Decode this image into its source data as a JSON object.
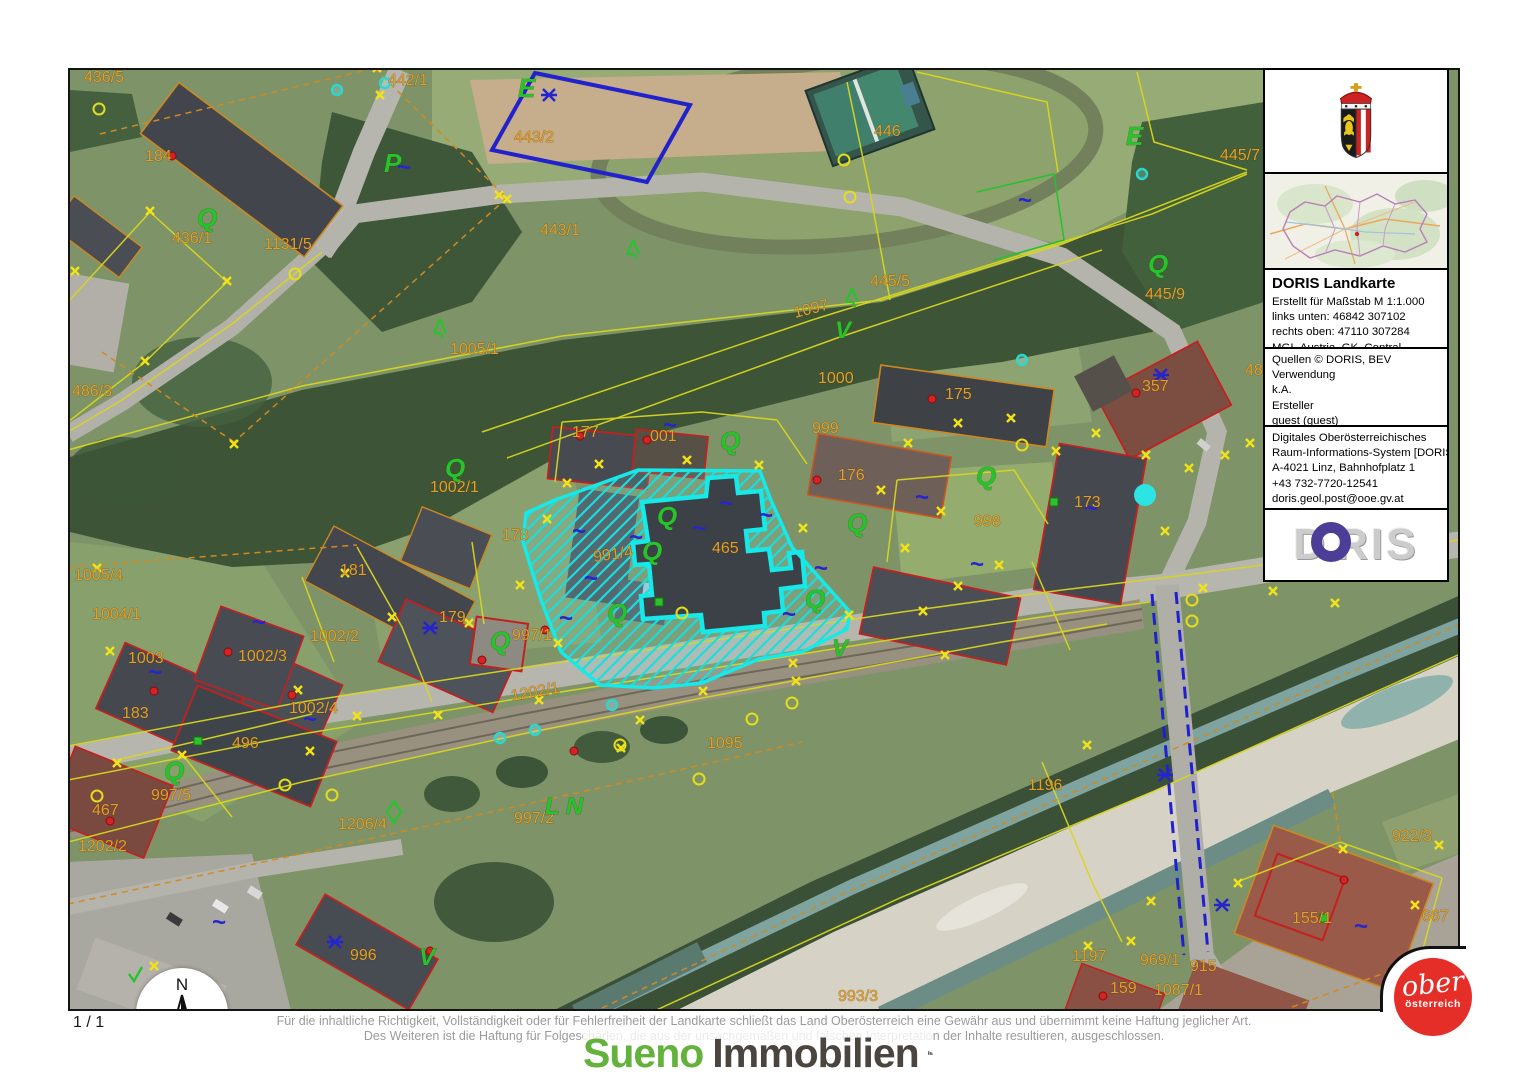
{
  "page": {
    "page_number": "1 / 1"
  },
  "scalebar": {
    "start": "0",
    "mid": "40",
    "unit": "m"
  },
  "north_label": "N",
  "disclaimer": {
    "line1": "Für die inhaltliche Richtigkeit, Vollständigkeit oder für Fehlerfreiheit der Landkarte schließt das Land Oberösterreich eine Gewähr aus und übernimmt keine Haftung jeglicher Art.",
    "line2": "Des Weiteren ist die Haftung für Folgeschäden, die aus der unsachgemäßen und falschen Interpretation der Inhalte resultieren, ausgeschlossen."
  },
  "branding": {
    "sueno_part1": "Sueno",
    "sueno_part2": "Immobilien",
    "ooe_line1": "ober",
    "ooe_line2": "österreich"
  },
  "sidebar": {
    "title": "DORIS Landkarte",
    "map_info": [
      "Erstellt für Maßstab M 1:1.000",
      "links unten: 46842 307102",
      "rechts oben: 47110 307284",
      "MGI_Austria_GK_Central"
    ],
    "source_info": [
      "Quellen © DORIS, BEV",
      "Verwendung",
      "k.A.",
      "Ersteller",
      "guest (guest)",
      "Erstellungsdatum: 28.01.2026"
    ],
    "contact_info": [
      "Digitales Oberösterreichisches",
      "Raum-Informations-System [DORIS]",
      "A-4021 Linz, Bahnhofplatz 1",
      "+43 732-7720-12541",
      "doris.geol.post@ooe.gv.at",
      "https://doris.ooe.gv.at"
    ],
    "logo": {
      "d": "D",
      "ris": "RIS"
    }
  },
  "map": {
    "highlight_color": "#17e8e8",
    "parcel_line_color": "#d8d61f",
    "label_color": "#e2a02a",
    "labels": [
      {
        "t": "436/5",
        "x": 82,
        "y": 80
      },
      {
        "t": "442/1",
        "x": 386,
        "y": 83
      },
      {
        "t": "443/2",
        "x": 512,
        "y": 140
      },
      {
        "t": "446",
        "x": 872,
        "y": 134
      },
      {
        "t": "445/7",
        "x": 1218,
        "y": 158
      },
      {
        "t": "436/1",
        "x": 170,
        "y": 241
      },
      {
        "t": "1131/5",
        "x": 262,
        "y": 247
      },
      {
        "t": "443/1",
        "x": 538,
        "y": 233
      },
      {
        "t": "445/5",
        "x": 868,
        "y": 284
      },
      {
        "t": "445/9",
        "x": 1143,
        "y": 297
      },
      {
        "t": "486/3",
        "x": 70,
        "y": 394
      },
      {
        "t": "1005/1",
        "x": 448,
        "y": 352
      },
      {
        "t": "1097",
        "x": 793,
        "y": 316,
        "r": -14
      },
      {
        "t": "1000",
        "x": 816,
        "y": 381
      },
      {
        "t": "175",
        "x": 943,
        "y": 397
      },
      {
        "t": "357",
        "x": 1140,
        "y": 389
      },
      {
        "t": "48",
        "x": 1243,
        "y": 373
      },
      {
        "t": "177",
        "x": 570,
        "y": 435
      },
      {
        "t": "001",
        "x": 648,
        "y": 439
      },
      {
        "t": "999",
        "x": 810,
        "y": 431
      },
      {
        "t": "176",
        "x": 836,
        "y": 478
      },
      {
        "t": "1002/1",
        "x": 428,
        "y": 490
      },
      {
        "t": "178",
        "x": 500,
        "y": 538
      },
      {
        "t": "465",
        "x": 710,
        "y": 551
      },
      {
        "t": "991/4",
        "x": 592,
        "y": 560,
        "r": -8
      },
      {
        "t": "173",
        "x": 1072,
        "y": 505
      },
      {
        "t": "998",
        "x": 972,
        "y": 524
      },
      {
        "t": "181",
        "x": 338,
        "y": 573
      },
      {
        "t": "1005/4",
        "x": 72,
        "y": 578
      },
      {
        "t": "1004/1",
        "x": 90,
        "y": 617
      },
      {
        "t": "179",
        "x": 437,
        "y": 620
      },
      {
        "t": "997/1",
        "x": 510,
        "y": 638
      },
      {
        "t": "1003",
        "x": 126,
        "y": 661
      },
      {
        "t": "1002/3",
        "x": 236,
        "y": 659
      },
      {
        "t": "1002/2",
        "x": 308,
        "y": 639
      },
      {
        "t": "183",
        "x": 120,
        "y": 716
      },
      {
        "t": "1002/4",
        "x": 287,
        "y": 711
      },
      {
        "t": "496",
        "x": 230,
        "y": 746
      },
      {
        "t": "1202/1",
        "x": 510,
        "y": 699,
        "r": -10
      },
      {
        "t": "1202/2",
        "x": 76,
        "y": 849
      },
      {
        "t": "997/5",
        "x": 149,
        "y": 798
      },
      {
        "t": "467",
        "x": 90,
        "y": 813
      },
      {
        "t": "1206/4",
        "x": 336,
        "y": 827
      },
      {
        "t": "997/2",
        "x": 512,
        "y": 821
      },
      {
        "t": "1095",
        "x": 705,
        "y": 746
      },
      {
        "t": "996",
        "x": 348,
        "y": 958
      },
      {
        "t": "1196",
        "x": 1026,
        "y": 788
      },
      {
        "t": "1197",
        "x": 1070,
        "y": 959
      },
      {
        "t": "969/1",
        "x": 1138,
        "y": 963
      },
      {
        "t": "915",
        "x": 1188,
        "y": 969
      },
      {
        "t": "159",
        "x": 1108,
        "y": 991
      },
      {
        "t": "1087/1",
        "x": 1152,
        "y": 993
      },
      {
        "t": "155/1",
        "x": 1290,
        "y": 921
      },
      {
        "t": "922/3",
        "x": 1390,
        "y": 839
      },
      {
        "t": "667",
        "x": 1420,
        "y": 919
      },
      {
        "t": "993/3",
        "x": 836,
        "y": 999
      },
      {
        "t": "184",
        "x": 143,
        "y": 159
      },
      {
        "t": "E",
        "x": 516,
        "y": 95,
        "c": "green",
        "s": 26,
        "i": 1
      },
      {
        "t": "E",
        "x": 1124,
        "y": 143,
        "c": "green",
        "s": 26,
        "i": 1
      },
      {
        "t": "P",
        "x": 382,
        "y": 170,
        "c": "green",
        "s": 26,
        "i": 1
      },
      {
        "t": "V",
        "x": 833,
        "y": 336,
        "c": "green",
        "s": 24,
        "i": 1
      },
      {
        "t": "V",
        "x": 830,
        "y": 654,
        "c": "green",
        "s": 24,
        "i": 1
      },
      {
        "t": "V",
        "x": 417,
        "y": 963,
        "c": "green",
        "s": 24,
        "i": 1
      },
      {
        "t": "L N",
        "x": 543,
        "y": 812,
        "c": "green",
        "s": 24,
        "i": 1
      },
      {
        "t": "Q",
        "x": 195,
        "y": 225,
        "c": "green",
        "s": 26,
        "i": 1
      },
      {
        "t": "Q",
        "x": 443,
        "y": 475,
        "c": "green",
        "s": 26,
        "i": 1
      },
      {
        "t": "Q",
        "x": 718,
        "y": 448,
        "c": "green",
        "s": 26,
        "i": 1
      },
      {
        "t": "Q",
        "x": 655,
        "y": 523,
        "c": "green",
        "s": 26,
        "i": 1
      },
      {
        "t": "Q",
        "x": 640,
        "y": 558,
        "c": "green",
        "s": 26,
        "i": 1
      },
      {
        "t": "Q",
        "x": 605,
        "y": 620,
        "c": "green",
        "s": 26,
        "i": 1
      },
      {
        "t": "Q",
        "x": 845,
        "y": 530,
        "c": "green",
        "s": 26,
        "i": 1
      },
      {
        "t": "Q",
        "x": 803,
        "y": 606,
        "c": "green",
        "s": 26,
        "i": 1
      },
      {
        "t": "Q",
        "x": 974,
        "y": 483,
        "c": "green",
        "s": 26,
        "i": 1
      },
      {
        "t": "Q",
        "x": 1146,
        "y": 271,
        "c": "green",
        "s": 26,
        "i": 1
      },
      {
        "t": "Q",
        "x": 162,
        "y": 778,
        "c": "green",
        "s": 26,
        "i": 1
      },
      {
        "t": "Q",
        "x": 488,
        "y": 648,
        "c": "green",
        "s": 26,
        "i": 1
      }
    ],
    "markers": [
      {
        "k": "sq",
        "x": 395,
        "y": 173
      },
      {
        "k": "sq",
        "x": 1016,
        "y": 206
      },
      {
        "k": "sq",
        "x": 661,
        "y": 431
      },
      {
        "k": "sq",
        "x": 570,
        "y": 537
      },
      {
        "k": "sq",
        "x": 627,
        "y": 543
      },
      {
        "k": "sq",
        "x": 690,
        "y": 534
      },
      {
        "k": "sq",
        "x": 717,
        "y": 509
      },
      {
        "k": "sq",
        "x": 757,
        "y": 521
      },
      {
        "k": "sq",
        "x": 812,
        "y": 574
      },
      {
        "k": "sq",
        "x": 780,
        "y": 620
      },
      {
        "k": "sq",
        "x": 582,
        "y": 584
      },
      {
        "k": "sq",
        "x": 146,
        "y": 678
      },
      {
        "k": "sq",
        "x": 250,
        "y": 628
      },
      {
        "k": "sq",
        "x": 301,
        "y": 725
      },
      {
        "k": "sq",
        "x": 557,
        "y": 624
      },
      {
        "k": "sq",
        "x": 913,
        "y": 503
      },
      {
        "k": "sq",
        "x": 1082,
        "y": 514
      },
      {
        "k": "sq",
        "x": 1352,
        "y": 932
      },
      {
        "k": "sq",
        "x": 210,
        "y": 928
      },
      {
        "k": "sq",
        "x": 968,
        "y": 570
      },
      {
        "k": "bc",
        "x": 428,
        "y": 626
      },
      {
        "k": "bc",
        "x": 1159,
        "y": 373
      },
      {
        "k": "bc",
        "x": 547,
        "y": 93
      },
      {
        "k": "bc",
        "x": 333,
        "y": 940
      },
      {
        "k": "bc",
        "x": 1163,
        "y": 773
      },
      {
        "k": "bc",
        "x": 1220,
        "y": 903
      },
      {
        "k": "dot",
        "x": 170,
        "y": 154
      },
      {
        "k": "dot",
        "x": 578,
        "y": 434
      },
      {
        "k": "dot",
        "x": 645,
        "y": 438
      },
      {
        "k": "dot",
        "x": 815,
        "y": 478
      },
      {
        "k": "dot",
        "x": 930,
        "y": 397
      },
      {
        "k": "dot",
        "x": 1134,
        "y": 391
      },
      {
        "k": "dot",
        "x": 152,
        "y": 689
      },
      {
        "k": "dot",
        "x": 290,
        "y": 693
      },
      {
        "k": "dot",
        "x": 226,
        "y": 650
      },
      {
        "k": "dot",
        "x": 543,
        "y": 628
      },
      {
        "k": "dot",
        "x": 572,
        "y": 749
      },
      {
        "k": "dot",
        "x": 108,
        "y": 819
      },
      {
        "k": "dot",
        "x": 428,
        "y": 949
      },
      {
        "k": "dot",
        "x": 1342,
        "y": 878
      },
      {
        "k": "dot",
        "x": 1101,
        "y": 994
      },
      {
        "k": "dot",
        "x": 480,
        "y": 658
      },
      {
        "k": "bigdot",
        "x": 1143,
        "y": 493
      },
      {
        "k": "tree",
        "x": 438,
        "y": 328
      },
      {
        "k": "tree",
        "x": 631,
        "y": 249
      },
      {
        "k": "tree",
        "x": 850,
        "y": 297
      },
      {
        "k": "dia",
        "x": 392,
        "y": 810
      },
      {
        "k": "chk",
        "x": 133,
        "y": 974
      },
      {
        "k": "gsq",
        "x": 1052,
        "y": 500
      },
      {
        "k": "gsq",
        "x": 1322,
        "y": 916
      },
      {
        "k": "gsq",
        "x": 196,
        "y": 739
      },
      {
        "k": "gsq",
        "x": 657,
        "y": 600
      }
    ],
    "xpts": [
      [
        378,
        93
      ],
      [
        497,
        193
      ],
      [
        148,
        209
      ],
      [
        73,
        269
      ],
      [
        225,
        279
      ],
      [
        143,
        359
      ],
      [
        95,
        566
      ],
      [
        108,
        649
      ],
      [
        296,
        688
      ],
      [
        343,
        571
      ],
      [
        390,
        615
      ],
      [
        355,
        714
      ],
      [
        308,
        749
      ],
      [
        180,
        753
      ],
      [
        115,
        761
      ],
      [
        467,
        621
      ],
      [
        518,
        583
      ],
      [
        556,
        641
      ],
      [
        537,
        698
      ],
      [
        638,
        718
      ],
      [
        565,
        481
      ],
      [
        545,
        517
      ],
      [
        597,
        462
      ],
      [
        685,
        458
      ],
      [
        757,
        463
      ],
      [
        801,
        526
      ],
      [
        847,
        613
      ],
      [
        791,
        661
      ],
      [
        701,
        689
      ],
      [
        921,
        609
      ],
      [
        956,
        584
      ],
      [
        997,
        563
      ],
      [
        903,
        546
      ],
      [
        939,
        509
      ],
      [
        879,
        488
      ],
      [
        906,
        441
      ],
      [
        956,
        421
      ],
      [
        1009,
        416
      ],
      [
        1054,
        449
      ],
      [
        1094,
        431
      ],
      [
        1144,
        453
      ],
      [
        1187,
        466
      ],
      [
        1223,
        453
      ],
      [
        1248,
        441
      ],
      [
        1163,
        529
      ],
      [
        1201,
        586
      ],
      [
        1271,
        589
      ],
      [
        1333,
        601
      ],
      [
        943,
        653
      ],
      [
        794,
        679
      ],
      [
        619,
        746
      ],
      [
        436,
        713
      ],
      [
        1085,
        743
      ],
      [
        1149,
        899
      ],
      [
        1129,
        939
      ],
      [
        1086,
        944
      ],
      [
        1236,
        881
      ],
      [
        1341,
        847
      ],
      [
        1437,
        843
      ],
      [
        1413,
        903
      ],
      [
        152,
        964
      ],
      [
        232,
        442
      ],
      [
        505,
        197
      ],
      [
        375,
        66
      ]
    ],
    "rings": [
      [
        97,
        107
      ],
      [
        293,
        272
      ],
      [
        680,
        611
      ],
      [
        842,
        158
      ],
      [
        848,
        195
      ],
      [
        1020,
        443
      ],
      [
        750,
        717
      ],
      [
        618,
        743
      ],
      [
        95,
        794
      ],
      [
        330,
        793
      ],
      [
        283,
        783
      ],
      [
        790,
        701
      ],
      [
        697,
        777
      ],
      [
        1190,
        598
      ],
      [
        1190,
        619
      ]
    ],
    "crings": [
      [
        335,
        88
      ],
      [
        383,
        81
      ],
      [
        1140,
        172
      ],
      [
        1020,
        358
      ],
      [
        498,
        736
      ],
      [
        533,
        728
      ],
      [
        610,
        703
      ]
    ]
  }
}
